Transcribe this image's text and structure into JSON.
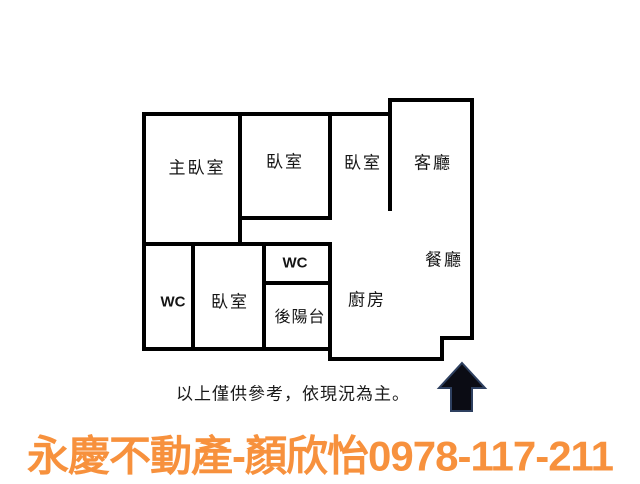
{
  "floorplan": {
    "type": "apartment-floor-plan",
    "rooms": [
      {
        "id": "master-bedroom",
        "label": "主臥室"
      },
      {
        "id": "bedroom-top-center",
        "label": "臥室"
      },
      {
        "id": "bedroom-top-right",
        "label": "臥室"
      },
      {
        "id": "living-room",
        "label": "客廳"
      },
      {
        "id": "dining-room",
        "label": "餐廳"
      },
      {
        "id": "kitchen",
        "label": "廚房"
      },
      {
        "id": "wc-left",
        "label": "WC"
      },
      {
        "id": "bedroom-bottom",
        "label": "臥室"
      },
      {
        "id": "wc-center",
        "label": "WC"
      },
      {
        "id": "back-balcony",
        "label": "後陽台"
      }
    ],
    "disclaimer": "以上僅供參考，依現況為主。",
    "arrow": {
      "direction": "up"
    }
  },
  "footer": {
    "text": "永慶不動產-顏欣怡0978-117-211"
  },
  "colors": {
    "background": "#FFFFFF",
    "wall": "#000000",
    "accent_orange": "#F7913D",
    "arrow_fill": "#0B0C14",
    "arrow_outline": "#2E4060"
  }
}
